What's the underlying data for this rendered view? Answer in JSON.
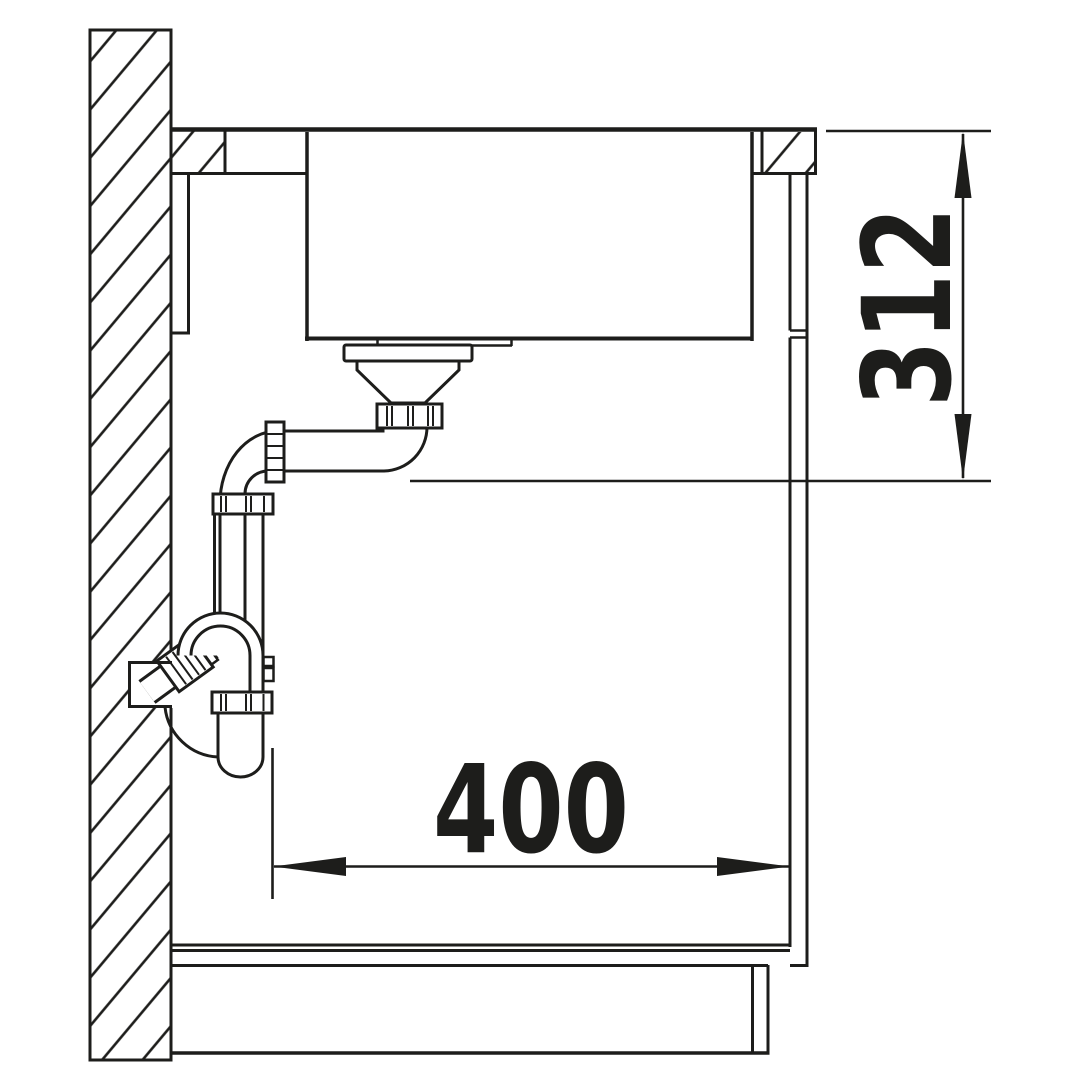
{
  "colors": {
    "ink": "#1d1d1b",
    "background": "#ffffff"
  },
  "dimensions": {
    "height": {
      "value": "312"
    },
    "width": {
      "value": "400"
    }
  }
}
